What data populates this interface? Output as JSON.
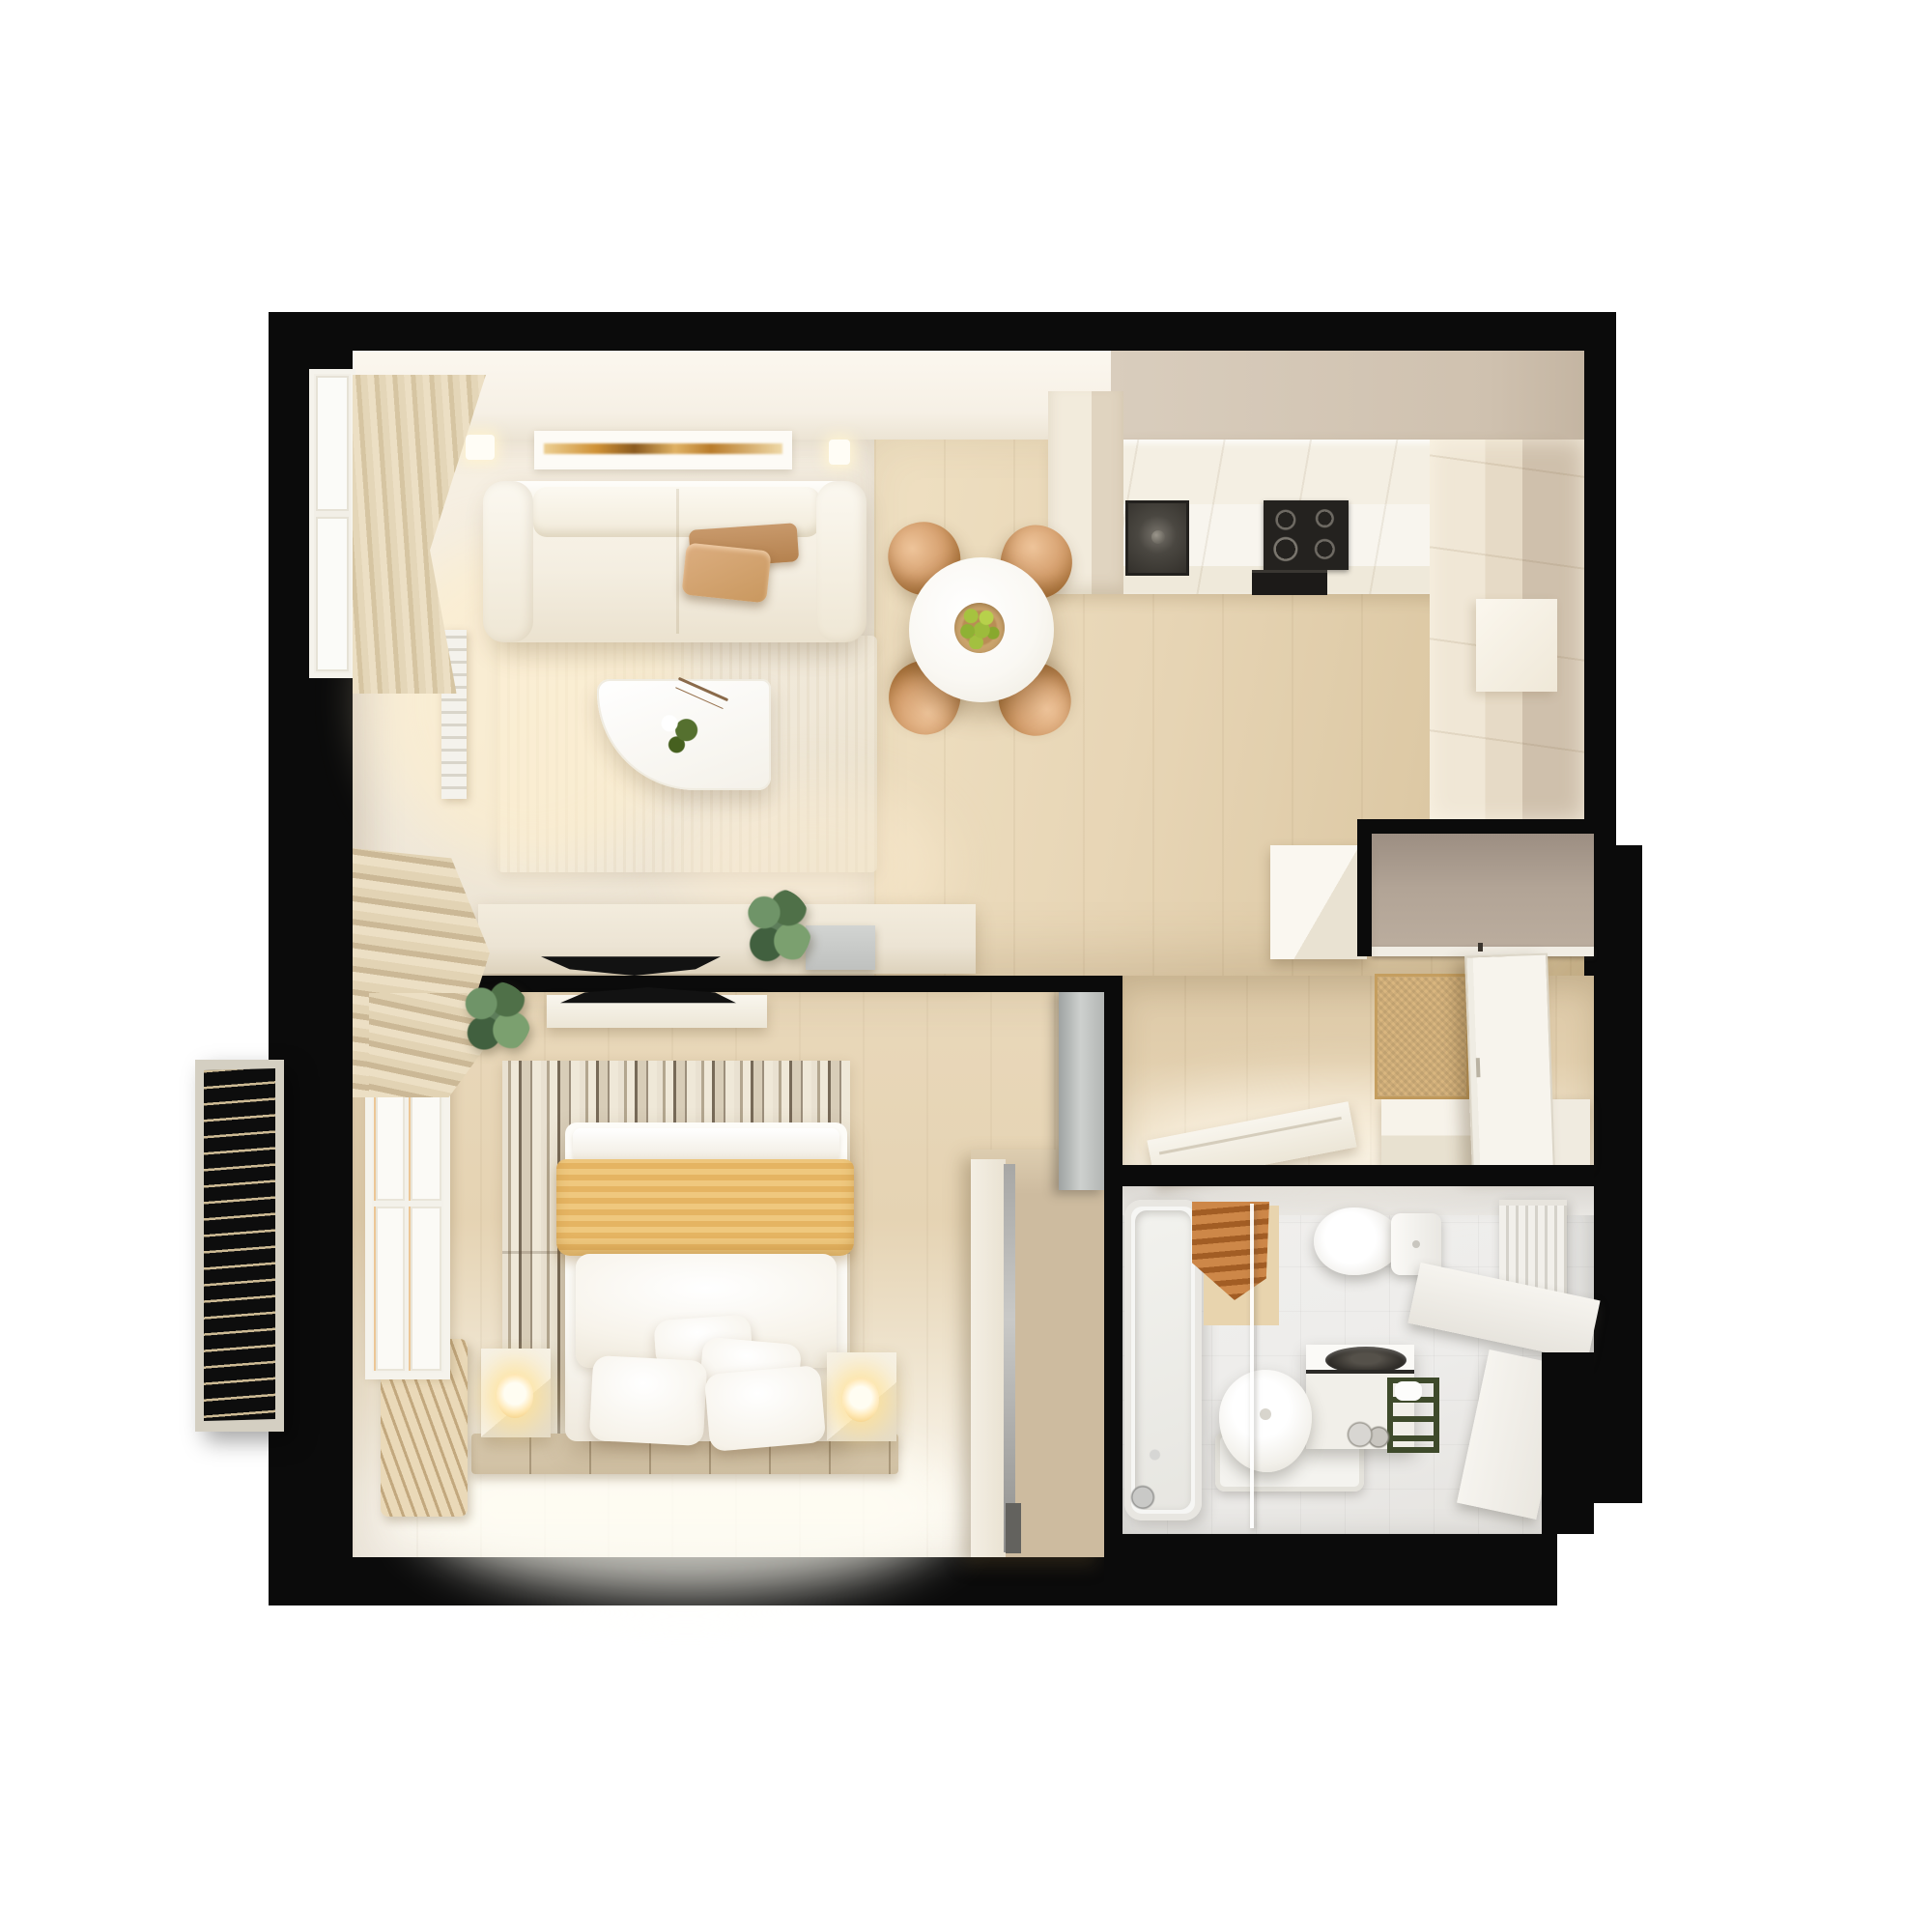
{
  "scene": {
    "description": "Photorealistic top-down 3D render of a one-bedroom apartment floor plan on a white background, thick black walls",
    "background": "#ffffff",
    "view": "top-down",
    "text_content": "none (image contains no visible text)"
  },
  "palette": {
    "wall": "#0b0b0b",
    "wall_beige": "#d9cdbd",
    "floor_wood": "#e7d5b5",
    "bath_floor": "#edecea",
    "sofa_cream": "#f4eee1",
    "pillow_tan": "#cf9f73",
    "chair_tan": "#d7a271",
    "bowl_tan": "#caa36c",
    "apple_green": "#a6c33f",
    "console_cream": "#ece4d4",
    "tv_black": "#121212",
    "plant_green": "#5d7d5a",
    "rug_stripe_dark": "#776a58",
    "blanket_orange": "#efc87e",
    "bed_white": "#fbfaf6",
    "platform_tile": "#dccdb2",
    "wardrobe_tan": "#cdbb9f",
    "closet_taupe": "#b2a496",
    "doormat_tan": "#d9b67f",
    "door_white": "#f7f4ed",
    "counter_white": "#f8f5ee",
    "cooktop_black": "#24221f",
    "basin_dark": "#2f2c28",
    "towel_copper": "#cd8748",
    "shower_mat": "#e8d4ae",
    "rack_green": "#3e4a2b",
    "balcony_frame": "#d4cfc2",
    "glow_warm": "#ffe9b8",
    "curtain_cream": "#ecdfc4"
  },
  "rooms": [
    {
      "name": "living-room",
      "furniture": [
        "cream-sofa",
        "two-tan-throw-pillows",
        "wall-artwork-amber-streak",
        "two-ceiling-spotlights",
        "cream-curtains",
        "left-window",
        "radiator",
        "area-rug",
        "white-curved-coffee-table",
        "green-vase-decor",
        "tv-console",
        "wall-tv",
        "potted-plant",
        "gray-media-box"
      ]
    },
    {
      "name": "dining-area",
      "furniture": [
        "round-white-table",
        "fruit-bowl-with-6-green-apples",
        "four-tan-chairs"
      ]
    },
    {
      "name": "kitchen",
      "furniture": [
        "l-shaped-white-counter",
        "dark-sink",
        "black-cooktop-4-burners",
        "built-in-oven",
        "tall-cream-cabinets"
      ]
    },
    {
      "name": "hallway-entry",
      "furniture": [
        "taupe-coat-niche-with-rail",
        "white-cabinet",
        "open-entry-door",
        "tan-doormat",
        "white-shoe-bench",
        "diagonal-bench"
      ]
    },
    {
      "name": "bedroom",
      "furniture": [
        "double-bed-white",
        "orange-striped-blanket",
        "five-white-pillows",
        "two-nightstands-with-lit-lamps",
        "striped-barcode-rug",
        "floating-tv-shelf",
        "wall-tv",
        "tiled-platform",
        "slatted-bench",
        "tan-wardrobe-with-mirror",
        "gray-sliding-door",
        "window-with-curtains",
        "potted-plant"
      ]
    },
    {
      "name": "bathroom",
      "furniture": [
        "bathtub-with-chrome-shower",
        "glass-shower-screen",
        "copper-towel-on-rail",
        "beige-mat",
        "toilet",
        "white-vanity-with-dark-round-basin",
        "freestanding-oval-basin",
        "shower-tray",
        "dark-green-towel-ladder",
        "toiletry-bottles",
        "white-radiator",
        "corner-benches"
      ]
    },
    {
      "name": "balcony",
      "furniture": [
        "dark-slatted-grille-floor-with-cream-frame"
      ]
    }
  ],
  "counts": {
    "dining_chairs": 4,
    "apples": 6,
    "bed_pillows": 4,
    "nightstands": 2
  }
}
